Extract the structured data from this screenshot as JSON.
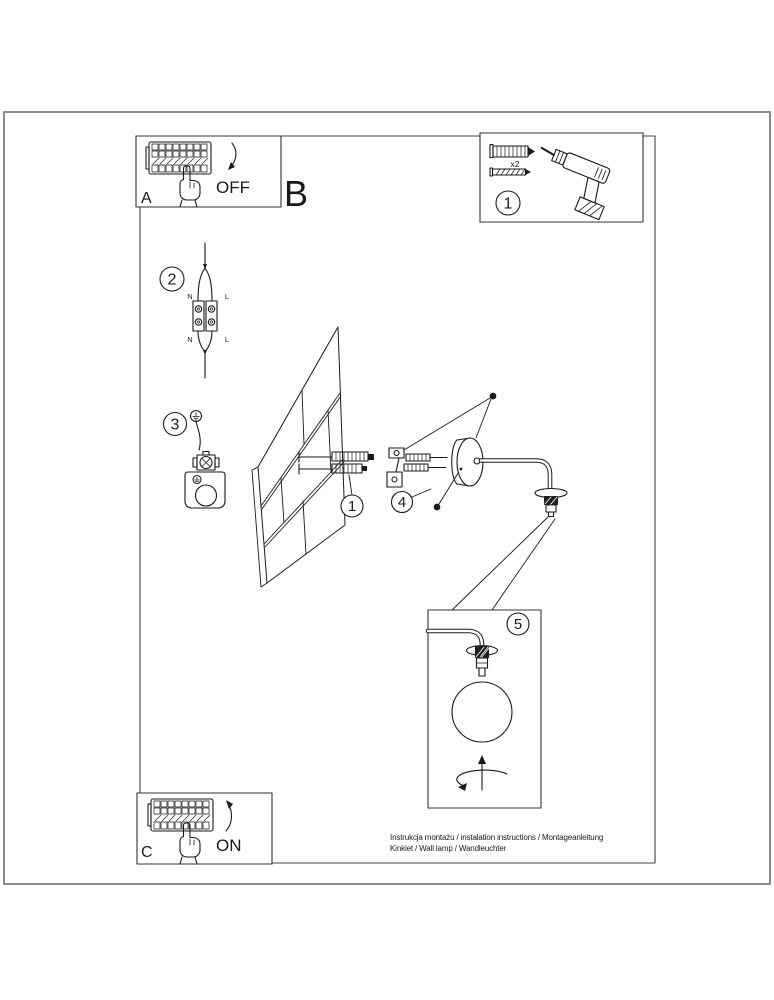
{
  "panels": {
    "a": {
      "letter": "A",
      "switch_label": "OFF"
    },
    "b": {
      "letter": "B"
    },
    "c": {
      "letter": "C",
      "switch_label": "ON"
    }
  },
  "parts_box": {
    "step_number": "1",
    "dowel_quantity": "x2"
  },
  "steps": {
    "wiring": {
      "number": "2",
      "terminal_top_left": "N",
      "terminal_top_right": "L",
      "terminal_bottom_left": "N",
      "terminal_bottom_right": "L"
    },
    "ground": {
      "number": "3"
    },
    "dowel_callout": {
      "number": "1"
    },
    "set_screw_callout": {
      "number": "4"
    },
    "globe_detail": {
      "number": "5"
    }
  },
  "footer": {
    "line1": "Instrukcja montażu / instalation instructions / Montageanleitung",
    "line2": "Kinkiet / Wall lamp / Wandleuchter"
  },
  "colors": {
    "line": "#1a1a1a",
    "page_border": "#8a8a8a"
  }
}
